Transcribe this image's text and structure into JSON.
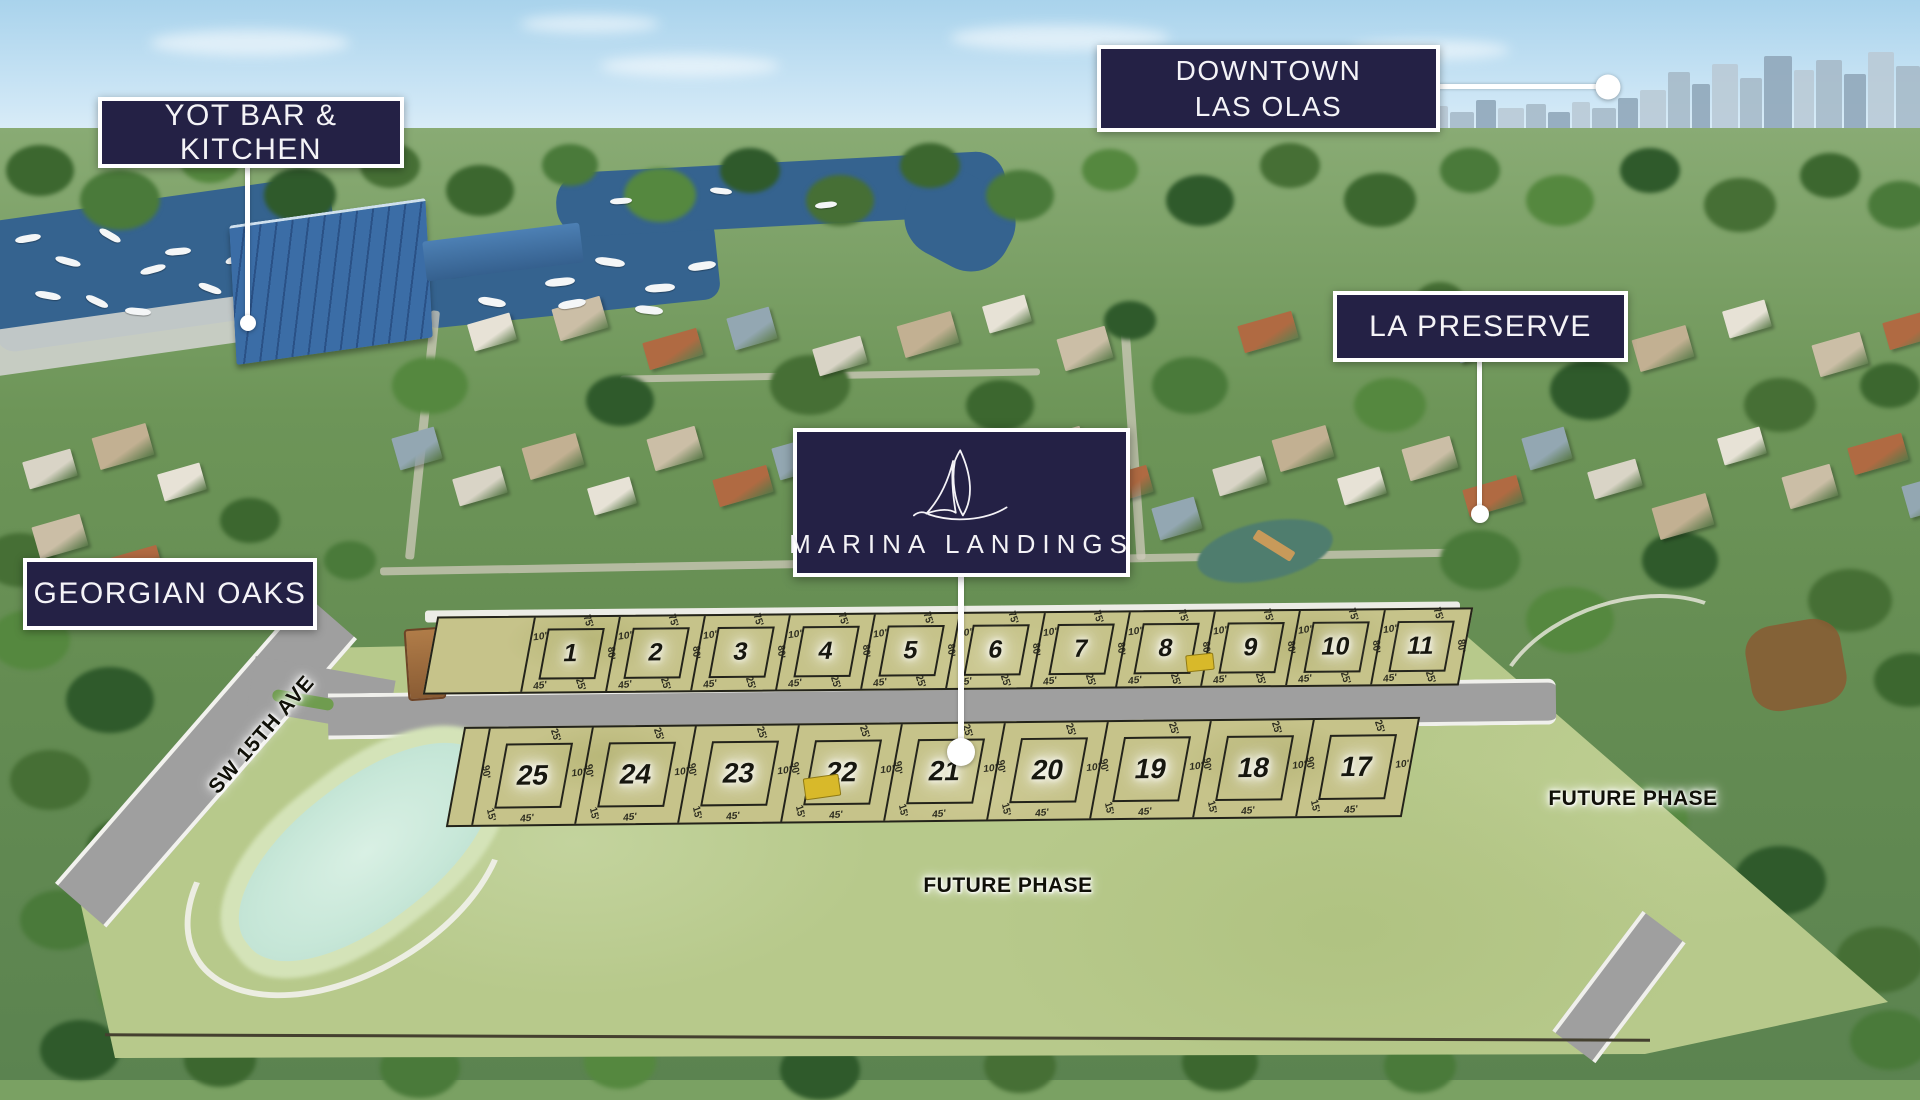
{
  "colors": {
    "badge_background": "#242145",
    "badge_border": "#ffffff",
    "badge_text": "#f4f3f7",
    "marker_white": "#ffffff",
    "parcel_green": "#b7c98b",
    "lot_tan": "#c6c38a",
    "road_gray": "#9f9f9f",
    "pond_aqua": "#c7e7d8",
    "sky_blue": "#a9d3ec",
    "water_blue": "#35638f"
  },
  "callouts": {
    "yot": {
      "label": "YOT BAR & KITCHEN"
    },
    "downtown": {
      "line1": "DOWNTOWN",
      "line2": "LAS OLAS"
    },
    "preserve": {
      "label": "LA PRESERVE"
    },
    "georgian": {
      "label": "GEORGIAN OAKS"
    }
  },
  "logo_card": {
    "name": "MARINA LANDINGS",
    "icon": "sailboat"
  },
  "site_plan": {
    "street_label": "SW 15TH AVE",
    "future_phase_center": "FUTURE PHASE",
    "future_phase_east": "FUTURE PHASE",
    "row_north": {
      "dims": {
        "top": "75'",
        "inner": "10'",
        "side": "80'",
        "bottom_a": "45'",
        "bottom_b": "25'"
      },
      "lots": [
        "1",
        "2",
        "3",
        "4",
        "5",
        "6",
        "7",
        "8",
        "9",
        "10",
        "11"
      ]
    },
    "row_south": {
      "dims": {
        "top": "25'",
        "inner": "10'",
        "side": "90'",
        "bottom_a": "15'",
        "bottom_b": "45'"
      },
      "lots": [
        "25",
        "24",
        "23",
        "22",
        "21",
        "20",
        "19",
        "18",
        "17"
      ]
    }
  }
}
